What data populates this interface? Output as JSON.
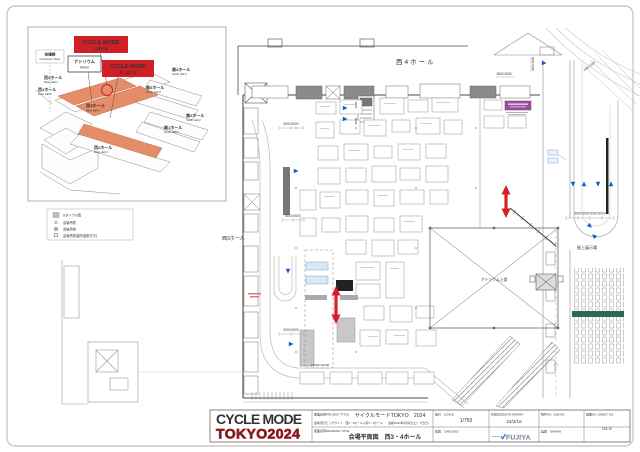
{
  "inset": {
    "badge_west_1": "CYCLE MODE",
    "badge_west_2": "西展示棟",
    "badge_roof_1": "CYCLE MODE",
    "badge_roof_2": "屋上展示場",
    "atrium_jp": "アトリウム",
    "atrium_en": "Atrium",
    "conf_jp": "会議棟",
    "conf_en": "Conference Tower",
    "halls": {
      "w1_jp": "西1ホール",
      "w1_en": "West Hall 1",
      "w2_jp": "西2ホール",
      "w2_en": "West Hall 2",
      "w3_jp": "西3ホール",
      "w3_en": "West Hall 3",
      "w4_jp": "西4ホール",
      "w4_en": "West Hall 4",
      "s1_jp": "南1ホール",
      "s1_en": "South Hall 1",
      "s2_jp": "南2ホール",
      "s2_en": "South Hall 2",
      "s3_jp": "南3ホール",
      "s3_en": "South Hall 3",
      "s4_jp": "南4ホール",
      "s4_en": "South Hall 4"
    }
  },
  "legend": {
    "item1": "Sタイプ小間",
    "item2": "会場吊物",
    "item3": "会場吊物",
    "item4": "会場吊物(操作盤取付き)"
  },
  "plan": {
    "hall_west4": "西4ホール",
    "hall_west3": "西3ホール",
    "rooftop": "屋上展示場",
    "atrium_upper": "アトリウム上部",
    "dim_3600": "3600  3600",
    "dim_3000v": "3000 3000",
    "dim_3000d": "3000 3000",
    "dim_5000a": "5000    5000",
    "dim_4000v": "4000",
    "dim_5000v": "5000",
    "dim_6000": "6000 6000",
    "dim_5000b": "5000    5000",
    "dim_5500": "5500  5500  5500   8000",
    "dim_area": "12000×30000"
  },
  "titleblock": {
    "logo_line1": "CYCLE MODE",
    "logo_line2": "TOKYO2024",
    "project_label_jp": "事業名称",
    "project_label_en": "PROJECT TITLE",
    "project_value": "サイクルモードTOKYO　2024",
    "venue_line": "会場/東京ビッグサイト　西3・4ホール＋南3・4ホール　　会期/2024年4月6日(土)・7日(日)",
    "drawing_label_jp": "図面名称",
    "drawing_label_en": "DRAWING TITLE",
    "drawing_value": "会場平面図　西3・4ホール",
    "scale_label_jp": "縮尺",
    "scale_label_en": "SCALE",
    "scale_value": "1/750",
    "checked_label_jp": "検図",
    "checked_label_en": "CHECKED",
    "date_label_jp": "作成日付",
    "date_label_en": "DATE DRAWN",
    "date_value": "24/2/16",
    "job_label_jp": "物件NO.",
    "job_label_en": "JOB NO.",
    "drawn_label_jp": "製図",
    "drawn_label_en": "DRAWN",
    "sheet_label_jp": "図面NO.",
    "sheet_label_en": "SHEET NO.",
    "sheet_value": "01-3",
    "fujiya": "FUJIYA"
  }
}
